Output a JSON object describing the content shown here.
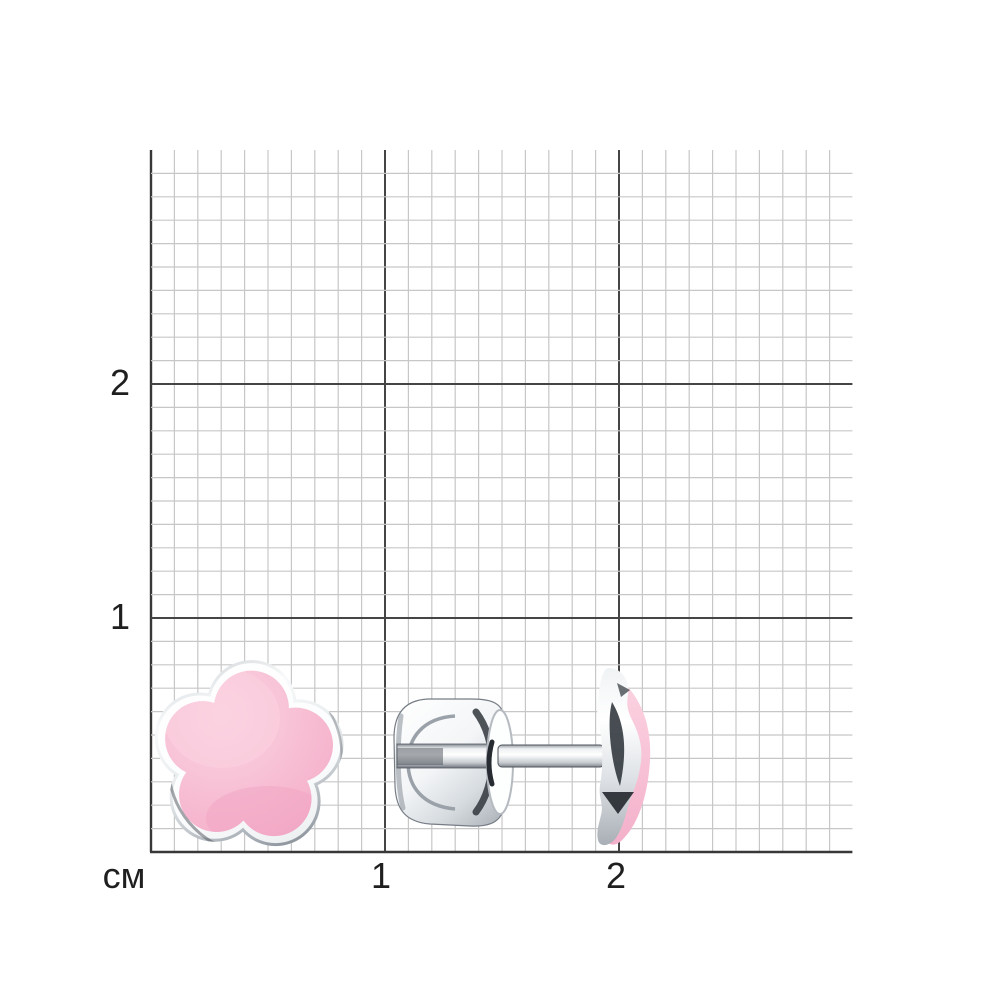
{
  "ruler": {
    "unit_label": "см",
    "y_labels": [
      "2",
      "1"
    ],
    "x_labels": [
      "1",
      "2"
    ]
  },
  "product": {
    "alt": "Silver stud earrings with pink enamel five-petal flower: front view and side view with ear-nut clasp"
  },
  "colors": {
    "background": "#ffffff",
    "grid_minor": "#c7c7c7",
    "grid_major": "#454545",
    "grid_border": "#383838",
    "text": "#1f1f1f",
    "enamel_pink": "#f8c2d6",
    "enamel_pink_light": "#fbd4e2",
    "enamel_pink_deep": "#f0a6c3",
    "silver_light": "#ffffff",
    "silver_mid": "#c3c8cd",
    "silver_dark": "#7d848c"
  }
}
